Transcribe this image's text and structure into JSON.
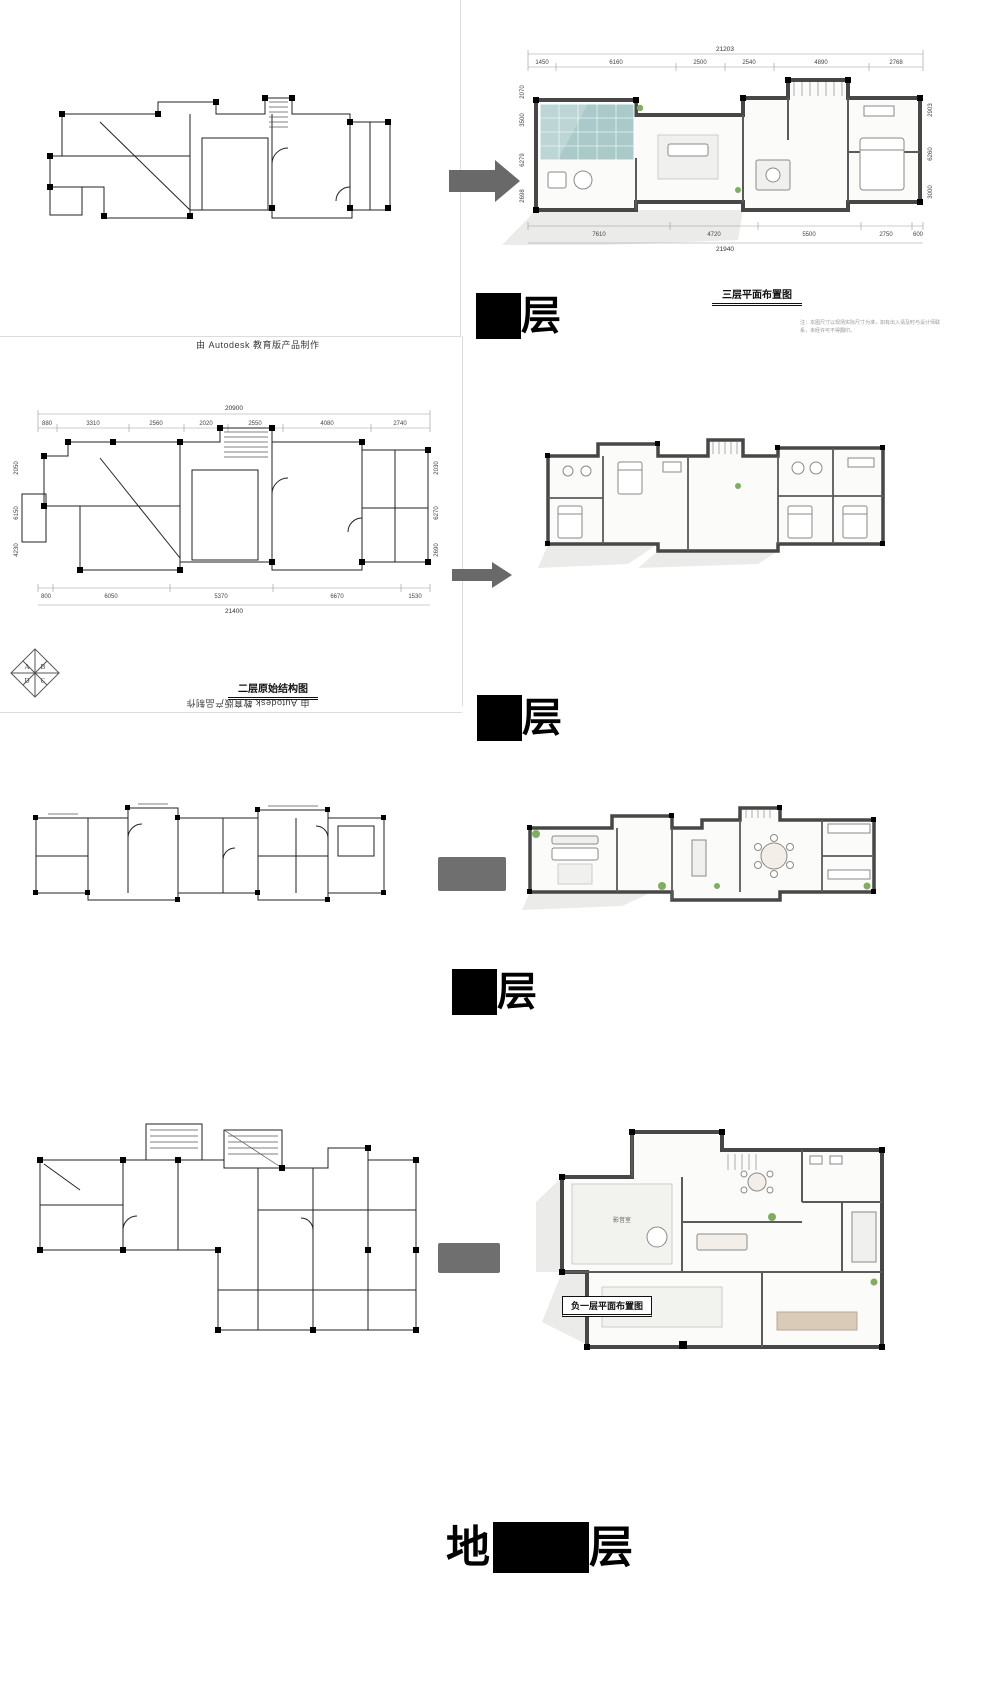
{
  "watermarks": {
    "top": "由 Autodesk 教育版产品制作",
    "bottom": "由 Autodesk 教育版产品制作"
  },
  "logo_letters": [
    "A",
    "B",
    "D",
    "C"
  ],
  "floor3": {
    "big_label": {
      "blocked": "三",
      "visible": "层"
    },
    "title": "三层平面布置图",
    "note": "注：本图尺寸以现场实际尺寸为准，如有出入请及时与设计师联系，未经许可不得翻印。",
    "dims": {
      "top_total": "21203",
      "top": [
        "1450",
        "6160",
        "2500",
        "2540",
        "4890",
        "2768"
      ],
      "bottom": [
        "7610",
        "4720",
        "5500",
        "2750",
        "600"
      ],
      "bottom_total": "21940",
      "left": [
        "2070",
        "3500",
        "6279",
        "2698"
      ],
      "right": [
        "2903",
        "6260",
        "3000"
      ]
    }
  },
  "floor2": {
    "big_label": {
      "blocked": "二",
      "visible": "层"
    },
    "title": "二层原始结构图",
    "dims": {
      "top_total": "20900",
      "top": [
        "880",
        "3310",
        "2560",
        "2020",
        "2550",
        "4080",
        "2740"
      ],
      "bottom": [
        "800",
        "6050",
        "5370",
        "6670",
        "1530"
      ],
      "bottom_total": "21400",
      "left": [
        "2050",
        "6150",
        "4230"
      ],
      "right": [
        "2030",
        "6270",
        "2690"
      ]
    }
  },
  "floor1": {
    "big_label": {
      "blocked": "一",
      "visible": "层"
    }
  },
  "basement": {
    "big_label": {
      "prefix": "地",
      "blocked": "下一",
      "visible": "层"
    },
    "title": "负一层平面布置图",
    "room_label": "影音室"
  }
}
